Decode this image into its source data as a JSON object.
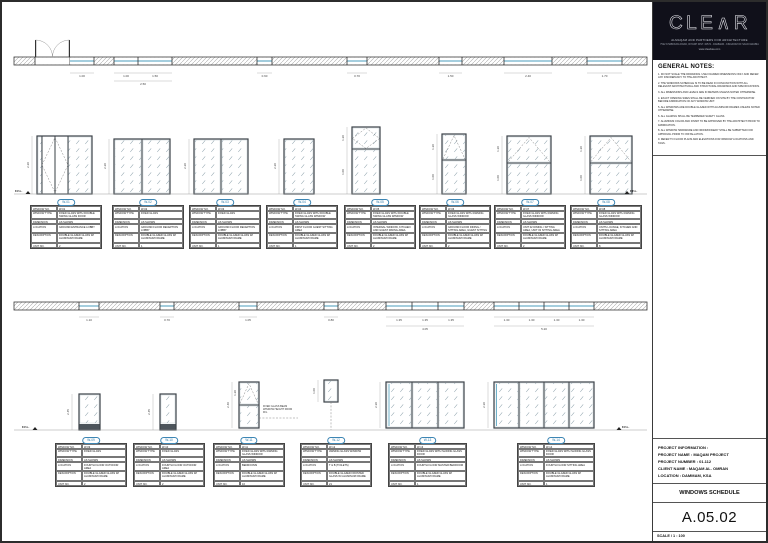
{
  "title_block": {
    "logo_text": "CLE∧R",
    "firm_name": "ALMAQAM AND PARTNERS FOR ARCHITECTURE",
    "firm_address": "7522 KHABOURA ROAD, RIYADH DIST. 32574 - DAMMAM - KINGDOM OF SAUDI ARABIA",
    "website": "www.clearksa.com",
    "project_info_heading": "PROJECT INFORMATION :",
    "project_name": "PROJECT NAME : MAQAM PROJECT",
    "project_number": "PROJECT NUMBER : 01.112",
    "client_name": "CLIENT NAME : MAQAM AL. OMRAN",
    "location": "LOCATION : DAMMAM, KSA",
    "sheet_title": "WINDOWS SCHEDULE",
    "sheet_number": "A.05.02",
    "scale_label": "SCALE / 1 : 100"
  },
  "general_notes": {
    "heading": "GENERAL NOTES:",
    "items": [
      "1. DO NOT SCALE THE DRAWINGS. USE FIGURED DIMENSIONS ONLY AND REFER ANY DISCREPANCY TO THE ARCHITECT.",
      "2. THE WINDOWS SCHEDULE IS TO BE READ IN CONJUNCTION WITH ALL RELEVANT ARCHITECTURAL AND STRUCTURAL DRAWINGS AND SPECIFICATIONS.",
      "3. ALL DIMENSIONS AND LEVELS ARE IN METERS UNLESS NOTED OTHERWISE.",
      "4. EXACT OPENING SIZES SHALL BE VERIFIED ON SITE BY THE CONTRACTOR BEFORE FABRICATION OF ANY WINDOW UNIT.",
      "5. ALL WINDOWS ARE DOUBLE GLAZED WITH ALUMINUM FRAMES UNLESS NOTED OTHERWISE.",
      "6. ALL GLAZING SHALL BE TEMPERED SAFETY GLASS.",
      "7. ALUMINUM COLOR AND FINISH TO BE APPROVED BY THE ARCHITECT PRIOR TO FABRICATION.",
      "8. ALL WINDOW HARDWARE AND IRONMONGERY SHALL BE SUBMITTED FOR APPROVAL PRIOR TO INSTALLATION.",
      "9. REFER TO FLOOR PLANS AND ELEVATIONS FOR WINDOW LOCATIONS AND TAGS."
    ]
  },
  "schedule_labels": {
    "window_no": "WINDOW NO.",
    "window_type": "WINDOW TYPE",
    "dimension": "DIMENSION",
    "location": "LOCATION",
    "description": "DESCRIPTION",
    "unit_no": "UNIT NO."
  },
  "windows": [
    {
      "no": "W-01",
      "type": "FIXED GLASS WITH DOUBLE SWING GLASS DOOR",
      "dimension": "AS SHOWN",
      "location": "GROUND ENTRANCE LOBBY",
      "description": "DOUBLE GLAZED GLASS W/ ALUMINUM FRAME",
      "units": "2"
    },
    {
      "no": "W-02",
      "type": "FIXED GLASS",
      "dimension": "AS SHOWN",
      "location": "GROUND FLOOR RECEPTION LOBBY",
      "description": "DOUBLE GLAZED GLASS W/ ALUMINUM FRAME",
      "units": "1"
    },
    {
      "no": "W-03",
      "type": "FIXED GLASS",
      "dimension": "AS SHOWN",
      "location": "GROUND FLOOR RECEPTION LOBBY",
      "description": "DOUBLE GLAZED GLASS W/ ALUMINUM FRAME",
      "units": "1"
    },
    {
      "no": "W-04",
      "type": "FIXED GLASS WITH DOUBLE SWING GLASS WINDOW",
      "dimension": "AS SHOWN",
      "location": "FIRST FLOOR GUEST SITTING AREA",
      "description": "DOUBLE GLAZED GLASS W/ ALUMINUM FRAME",
      "units": "1"
    },
    {
      "no": "W-05",
      "type": "FIXED GLASS WITH DOUBLE SWING GLASS WINDOW",
      "dimension": "AS SHOWN",
      "location": "INTERNAL WINDOW, KITCHEN AND GUEST DINING AREA",
      "description": "DOUBLE GLAZED GLASS W/ ALUMINUM FRAME",
      "units": "2"
    },
    {
      "no": "W-06",
      "type": "FIXED GLASS WITH AWNING GLASS WINDOW",
      "dimension": "AS SHOWN",
      "location": "GROUND FLOOR DINING / SITTING AREA, GUEST SITTING AREA",
      "description": "DOUBLE GLAZED GLASS W/ ALUMINUM FRAME",
      "units": "2"
    },
    {
      "no": "W-07",
      "type": "FIXED GLASS WITH AWNING GLASS WINDOW",
      "dimension": "AS SHOWN",
      "location": "UNIT 02 DINING / SITTING AREA, UNIT 03 SITTING AREA",
      "description": "DOUBLE GLAZED GLASS W/ ALUMINUM FRAME",
      "units": "2"
    },
    {
      "no": "W-08",
      "type": "FIXED GLASS WITH AWNING GLASS WINDOW",
      "dimension": "AS SHOWN",
      "location": "UNITS LOUNGE, KITCHEN AND SITTING AREA",
      "description": "DOUBLE GLAZED GLASS W/ ALUMINUM FRAME",
      "units": "8"
    },
    {
      "no": "W-09",
      "type": "FIXED GLASS",
      "dimension": "AS SHOWN",
      "location": "FOURTH FLOOR OUTDOOR AREA",
      "description": "DOUBLE GLAZED GLASS W/ ALUMINUM FRAME",
      "units": "2"
    },
    {
      "no": "W-10",
      "type": "FIXED GLASS",
      "dimension": "AS SHOWN",
      "location": "FOURTH FLOOR OUTDOOR AREA",
      "description": "DOUBLE GLAZED GLASS W/ ALUMINUM FRAME",
      "units": "2"
    },
    {
      "no": "W-11",
      "type": "FIXED GLASS WITH AWNING GLASS WINDOW",
      "dimension": "AS SHOWN",
      "location": "BEDROOMS",
      "description": "DOUBLE GLAZED GLASS W/ ALUMINUM FRAME",
      "units": "16"
    },
    {
      "no": "W-12",
      "type": "AWNING GLASS WINDOW",
      "dimension": "AS SHOWN",
      "location": "T & B (TOILETS)",
      "description": "DOUBLE GLAZED FROSTED GLASS W/ ALUMINUM FRAME",
      "units": "21"
    },
    {
      "no": "W-13",
      "type": "FIXED GLASS WITH SLIDING GLASS DOOR",
      "dimension": "AS SHOWN",
      "location": "FOURTH FLOOR MASTER BEDROOM",
      "description": "DOUBLE GLAZED GLASS W/ ALUMINUM FRAME",
      "units": "1"
    },
    {
      "no": "W-14",
      "type": "FIXED GLASS WITH SLIDING GLASS DOOR",
      "dimension": "AS SHOWN",
      "location": "FOURTH FLOOR SITTING AREA",
      "description": "DOUBLE GLAZED GLASS W/ ALUMINUM FRAME",
      "units": "1"
    }
  ],
  "annotations": {
    "ffl": "F.F.L.",
    "w11_note": "FIXED GLASS BEAM WINDOW HEIGHT FROM FFL"
  },
  "dims": {
    "top_plan": [
      "1.00",
      "1.00",
      "1.50",
      "2.50",
      "0.60",
      "0.70",
      "1.50",
      "2.40",
      "1.70"
    ],
    "bottom_plan": [
      "1.10",
      "0.70",
      "1.05",
      "0.80",
      "1.35",
      "1.35",
      "1.35",
      "4.05",
      "1.30",
      "1.30",
      "1.30",
      "1.30",
      "5.20"
    ],
    "top_elev": [
      "2.20",
      "2.20",
      "2.20",
      "2.20",
      "1.20",
      "1.00",
      "1.20",
      "1.00",
      "1.20",
      "1.00",
      "1.20",
      "1.00"
    ],
    "bottom_elev": [
      "2.45",
      "2.45",
      "2.40",
      "1.20",
      "1.00",
      "2.30",
      "2.30"
    ]
  }
}
